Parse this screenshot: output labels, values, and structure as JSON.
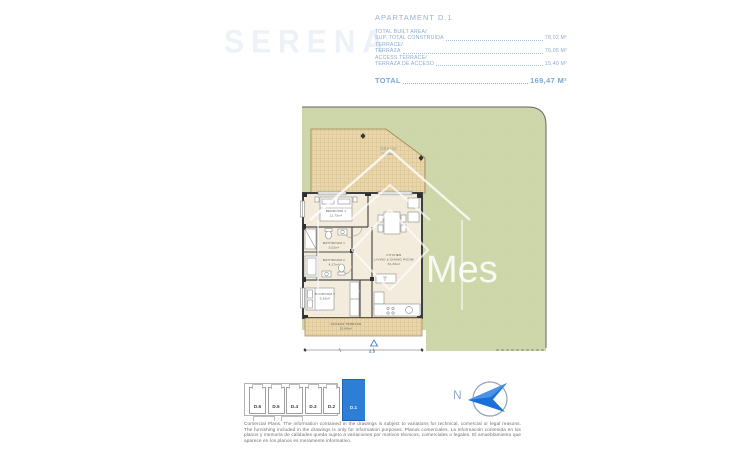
{
  "watermarks": {
    "brand": "SERENA",
    "center": "Mes"
  },
  "header": {
    "title": "APARTAMENT D.1",
    "rows": [
      {
        "line1": "TOTAL BUILT AREA/",
        "line2": "SUP. TOTAL CONSTRUIDA",
        "value": "78,02 M²"
      },
      {
        "line1": "TERRACE/",
        "line2": "TERRAZA",
        "value": "76,05 M²"
      },
      {
        "line1": "ACCESS TERRACE/",
        "line2": "TERRAZA DE ACCESO",
        "value": "15,40 M²"
      }
    ],
    "total_label": "TOTAL",
    "total_value": "169,47 M²"
  },
  "floorplan": {
    "terrace": {
      "name": "TERRACE",
      "area": "76,05m²"
    },
    "access_terrace": {
      "name": "ACCESS TERRACE",
      "area": "15,40m²"
    },
    "entrance_label": "d.1",
    "rooms": {
      "bedroom1": {
        "name": "BEDROOM 1",
        "area": "11,75m²"
      },
      "bathroom1": {
        "name": "BATHROOM 1",
        "area": "3,52m²"
      },
      "bathroom2": {
        "name": "BATHROOM 2",
        "area": "4,17m²"
      },
      "bedroom2": {
        "name": "BEDROOM 2",
        "area": "9,35m²"
      },
      "living": {
        "name": "KITCHEN",
        "name2": "LIVING & DINING ROOM",
        "area": "31,36m²"
      }
    }
  },
  "keyplan": {
    "units": [
      "D.6",
      "D.5",
      "D.4",
      "D.3",
      "D.2",
      "D.1"
    ],
    "highlighted": "D.1"
  },
  "north": {
    "label": "N"
  },
  "disclaimer": "Comercial Plans. The information contained in the drawings is subject to variations for technical, comercial or legal reasons. The furnishing included in the drawings is only for information purposes. Planos comerciales. La información contenida en los planos y memoria de calidades queda sujeto a variaciones por motivos técnicos, comerciales o legales. El amueblamiento que aparece en los planos es meramente informativo.",
  "colors": {
    "accent_blue": "#2d7fd6",
    "header_blue": "#8caacd",
    "plan_green": "#cdd7a9",
    "terrace_tan": "#e9d6ab"
  }
}
